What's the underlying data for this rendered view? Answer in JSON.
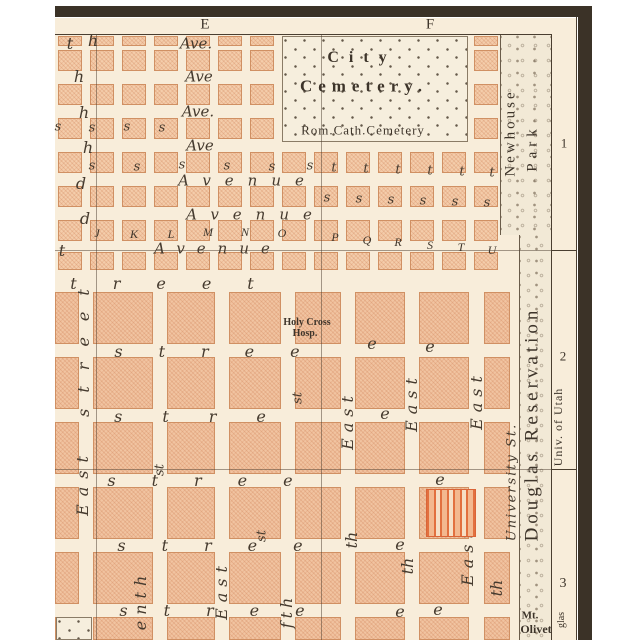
{
  "margins": {
    "top_cols": [
      {
        "label": "E",
        "x": 205
      },
      {
        "label": "F",
        "x": 430
      }
    ],
    "right_rows": [
      {
        "label": "1",
        "y": 143
      },
      {
        "label": "2",
        "y": 356
      },
      {
        "label": "3",
        "y": 584
      }
    ]
  },
  "features": {
    "cemetery_line1": "City",
    "cemetery_line2": "Cemetery.",
    "cemetery_sub": "Rom.Cath.Cemetery",
    "newhouse_line1": "Newhouse",
    "newhouse_line2": "Park",
    "reservation": "Douglas Reservation",
    "univ_utah": "Univ. of Utah",
    "university_st": "University St.",
    "hospital_line1": "Holy Cross",
    "hospital_line2": "Hosp.",
    "mt_line1": "Mt.",
    "mt_line2": "Olivet",
    "margin_fragment": "glas"
  },
  "map": {
    "letters": [
      {
        "t": "t",
        "x": 70,
        "y": 44
      },
      {
        "t": "h",
        "x": 93,
        "y": 41
      },
      {
        "t": "h",
        "x": 79,
        "y": 77
      },
      {
        "t": "h",
        "x": 84,
        "y": 113
      },
      {
        "t": "h",
        "x": 88,
        "y": 148
      },
      {
        "t": "d",
        "x": 81,
        "y": 184
      },
      {
        "t": "d",
        "x": 85,
        "y": 219
      },
      {
        "t": "t",
        "x": 62,
        "y": 251
      },
      {
        "t": "Ave.",
        "x": 196,
        "y": 44,
        "fs": 15
      },
      {
        "t": "Ave",
        "x": 199,
        "y": 77,
        "fs": 15
      },
      {
        "t": "Ave.",
        "x": 198,
        "y": 112,
        "fs": 15
      },
      {
        "t": "Ave",
        "x": 200,
        "y": 146,
        "fs": 15
      },
      {
        "t": "Avenue",
        "x": 248,
        "y": 181,
        "ls": 14,
        "fs": 15
      },
      {
        "t": "Avenue",
        "x": 256,
        "y": 215,
        "ls": 14,
        "fs": 15
      },
      {
        "t": "Avenue",
        "x": 218,
        "y": 249,
        "ls": 12,
        "fs": 15
      },
      {
        "t": "s",
        "x": 58,
        "y": 127,
        "fs": 13
      },
      {
        "t": "s",
        "x": 92,
        "y": 128,
        "fs": 13
      },
      {
        "t": "s",
        "x": 127,
        "y": 127,
        "fs": 13
      },
      {
        "t": "s",
        "x": 162,
        "y": 128,
        "fs": 13
      },
      {
        "t": "s",
        "x": 92,
        "y": 166,
        "fs": 13
      },
      {
        "t": "s",
        "x": 137,
        "y": 167,
        "fs": 13
      },
      {
        "t": "s",
        "x": 182,
        "y": 165,
        "fs": 13
      },
      {
        "t": "s",
        "x": 227,
        "y": 166,
        "fs": 13
      },
      {
        "t": "s",
        "x": 272,
        "y": 167,
        "fs": 13
      },
      {
        "t": "s",
        "x": 310,
        "y": 166,
        "fs": 13
      },
      {
        "t": "t",
        "x": 334,
        "y": 168,
        "fs": 13
      },
      {
        "t": "t",
        "x": 366,
        "y": 169,
        "fs": 13
      },
      {
        "t": "t",
        "x": 398,
        "y": 170,
        "fs": 13
      },
      {
        "t": "t",
        "x": 430,
        "y": 171,
        "fs": 13
      },
      {
        "t": "t",
        "x": 462,
        "y": 172,
        "fs": 13
      },
      {
        "t": "t",
        "x": 492,
        "y": 173,
        "fs": 13
      },
      {
        "t": "s",
        "x": 327,
        "y": 198,
        "fs": 13
      },
      {
        "t": "s",
        "x": 359,
        "y": 199,
        "fs": 13
      },
      {
        "t": "s",
        "x": 391,
        "y": 200,
        "fs": 13
      },
      {
        "t": "s",
        "x": 423,
        "y": 201,
        "fs": 13
      },
      {
        "t": "s",
        "x": 455,
        "y": 202,
        "fs": 13
      },
      {
        "t": "s",
        "x": 487,
        "y": 203,
        "fs": 13
      },
      {
        "t": "J",
        "x": 97,
        "y": 233,
        "cls": "cap"
      },
      {
        "t": "K",
        "x": 134,
        "y": 234,
        "cls": "cap"
      },
      {
        "t": "L",
        "x": 171,
        "y": 234,
        "cls": "cap"
      },
      {
        "t": "M",
        "x": 208,
        "y": 232,
        "cls": "cap"
      },
      {
        "t": "N",
        "x": 245,
        "y": 232,
        "cls": "cap"
      },
      {
        "t": "O",
        "x": 282,
        "y": 233,
        "cls": "cap"
      },
      {
        "t": "P",
        "x": 335,
        "y": 237,
        "cls": "cap"
      },
      {
        "t": "Q",
        "x": 367,
        "y": 240,
        "cls": "cap"
      },
      {
        "t": "R",
        "x": 398,
        "y": 242,
        "cls": "cap"
      },
      {
        "t": "S",
        "x": 430,
        "y": 245,
        "cls": "cap"
      },
      {
        "t": "T",
        "x": 461,
        "y": 247,
        "cls": "cap"
      },
      {
        "t": "U",
        "x": 492,
        "y": 250,
        "cls": "cap"
      },
      {
        "t": "treet",
        "x": 180,
        "y": 284,
        "ls": 36
      },
      {
        "t": "stree",
        "x": 225,
        "y": 352,
        "ls": 36
      },
      {
        "t": "stre",
        "x": 210,
        "y": 417,
        "ls": 40
      },
      {
        "t": "stree",
        "x": 218,
        "y": 481,
        "ls": 36
      },
      {
        "t": "stree",
        "x": 228,
        "y": 546,
        "ls": 36
      },
      {
        "t": "stree",
        "x": 230,
        "y": 611,
        "ls": 36
      },
      {
        "t": "e",
        "x": 372,
        "y": 344
      },
      {
        "t": "e",
        "x": 430,
        "y": 347
      },
      {
        "t": "e",
        "x": 385,
        "y": 414
      },
      {
        "t": "e",
        "x": 440,
        "y": 480
      },
      {
        "t": "e",
        "x": 400,
        "y": 545
      },
      {
        "t": "e",
        "x": 400,
        "y": 612
      },
      {
        "t": "e",
        "x": 438,
        "y": 610
      },
      {
        "t": "street",
        "x": 84,
        "y": 345,
        "ls": 16,
        "v": 1
      },
      {
        "t": "East",
        "x": 83,
        "y": 482,
        "ls": 8,
        "v": 1
      },
      {
        "t": "East",
        "x": 222,
        "y": 590,
        "ls": 6,
        "v": 1
      },
      {
        "t": "enth",
        "x": 141,
        "y": 600,
        "ls": 6,
        "v": 1
      },
      {
        "t": "fth",
        "x": 287,
        "y": 611,
        "ls": 4,
        "v": 1
      },
      {
        "t": "East",
        "x": 348,
        "y": 420,
        "ls": 6,
        "v": 1
      },
      {
        "t": "th",
        "x": 352,
        "y": 540,
        "v": 1
      },
      {
        "t": "East",
        "x": 412,
        "y": 402,
        "ls": 6,
        "v": 1
      },
      {
        "t": "th",
        "x": 408,
        "y": 566,
        "v": 1
      },
      {
        "t": "East",
        "x": 477,
        "y": 400,
        "ls": 6,
        "v": 1
      },
      {
        "t": "East",
        "x": 468,
        "y": 556,
        "ls": 6,
        "v": 1
      },
      {
        "t": "th",
        "x": 497,
        "y": 588,
        "v": 1
      },
      {
        "t": "st",
        "x": 160,
        "y": 470,
        "fs": 13,
        "v": 1
      },
      {
        "t": "st",
        "x": 262,
        "y": 536,
        "fs": 13,
        "v": 1
      },
      {
        "t": "st",
        "x": 298,
        "y": 398,
        "fs": 13,
        "v": 1
      }
    ],
    "block_grids": [
      {
        "name": "avenues",
        "w": 24,
        "cols_x": [
          58,
          90,
          122,
          154,
          186,
          218,
          250,
          282,
          314,
          346,
          378,
          410,
          442,
          474
        ],
        "rows_y": [
          36,
          50,
          84,
          118,
          152,
          186,
          220,
          252
        ],
        "rows_h": [
          10,
          21,
          21,
          21,
          21,
          21,
          21,
          18
        ]
      },
      {
        "name": "lower",
        "cols": [
          {
            "x": 55,
            "w": 24
          },
          {
            "x": 93,
            "w": 60
          },
          {
            "x": 167,
            "w": 48
          },
          {
            "x": 229,
            "w": 52
          },
          {
            "x": 295,
            "w": 46
          },
          {
            "x": 355,
            "w": 50
          },
          {
            "x": 419,
            "w": 50
          },
          {
            "x": 484,
            "w": 26
          }
        ],
        "rows": [
          {
            "y": 292,
            "h": 52
          },
          {
            "y": 357,
            "h": 52
          },
          {
            "y": 422,
            "h": 52
          },
          {
            "y": 487,
            "h": 52
          },
          {
            "y": 552,
            "h": 52
          },
          {
            "y": 617,
            "h": 23
          }
        ]
      }
    ]
  }
}
